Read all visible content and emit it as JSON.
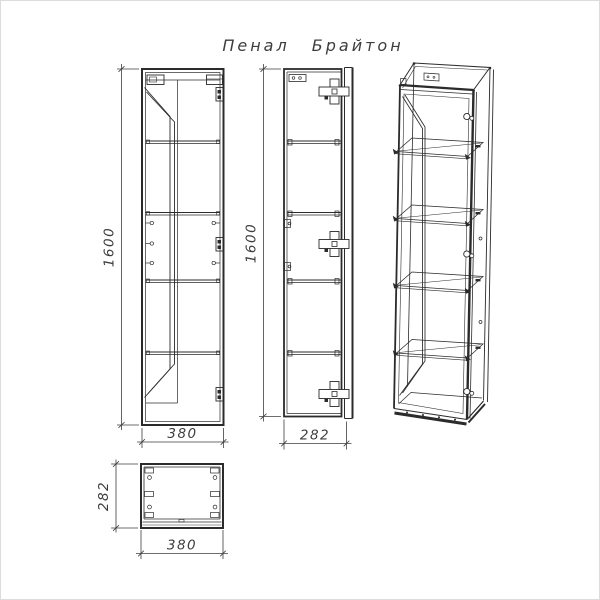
{
  "title": "Пенал Брайтон",
  "colors": {
    "line": "#2b2b2b",
    "dimension": "#3d3d3d",
    "background": "#ffffff"
  },
  "views": {
    "front": {
      "height_label": "1600",
      "width_label": "380"
    },
    "side": {
      "height_label": "1600",
      "depth_label": "282"
    },
    "top": {
      "depth_label": "282",
      "width_label": "380"
    }
  }
}
